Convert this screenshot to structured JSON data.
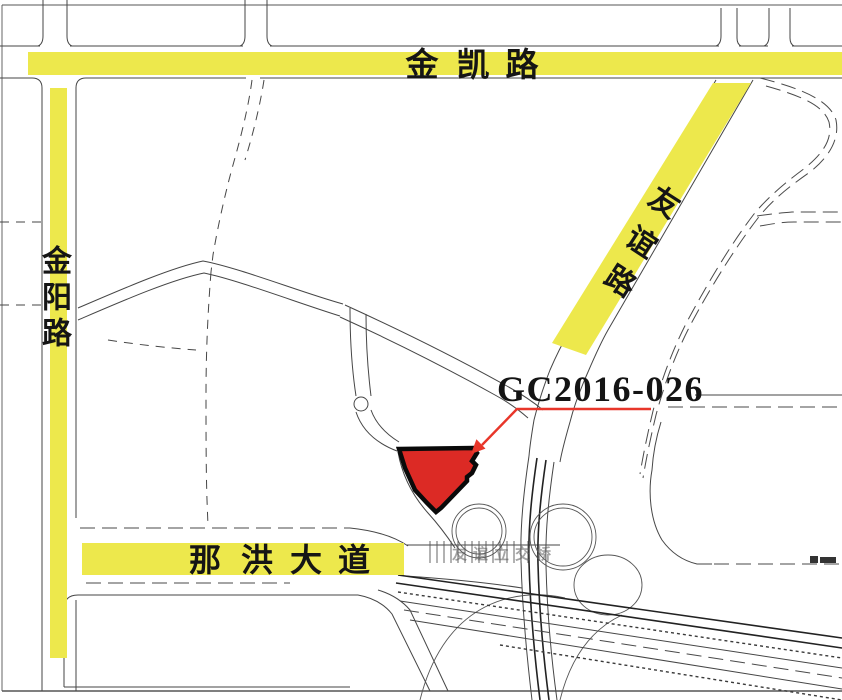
{
  "parcel": {
    "label": "GC2016-026",
    "fill": "#DC2A25",
    "outline": "#0A0A0A",
    "leader_color": "#E8362A"
  },
  "roads": {
    "jinkai": {
      "name": "金凯路",
      "chars": [
        "金",
        "凯",
        "路"
      ]
    },
    "jinyang": {
      "name": "金阳路",
      "chars": [
        "金",
        "阳",
        "路"
      ]
    },
    "youyi": {
      "name": "友谊路",
      "chars": [
        "友",
        "谊",
        "路"
      ]
    },
    "nahong": {
      "name": "那洪大道",
      "chars": [
        "那",
        "洪",
        "大",
        "道"
      ]
    }
  },
  "interchange": {
    "label": "友谊立交桥"
  },
  "colors": {
    "highlight_yellow": "#EDE84C",
    "parcel_red": "#DC2A25",
    "leader_red": "#E8362A",
    "road_line": "#3D3D3D",
    "background": "#FFFFFF"
  }
}
